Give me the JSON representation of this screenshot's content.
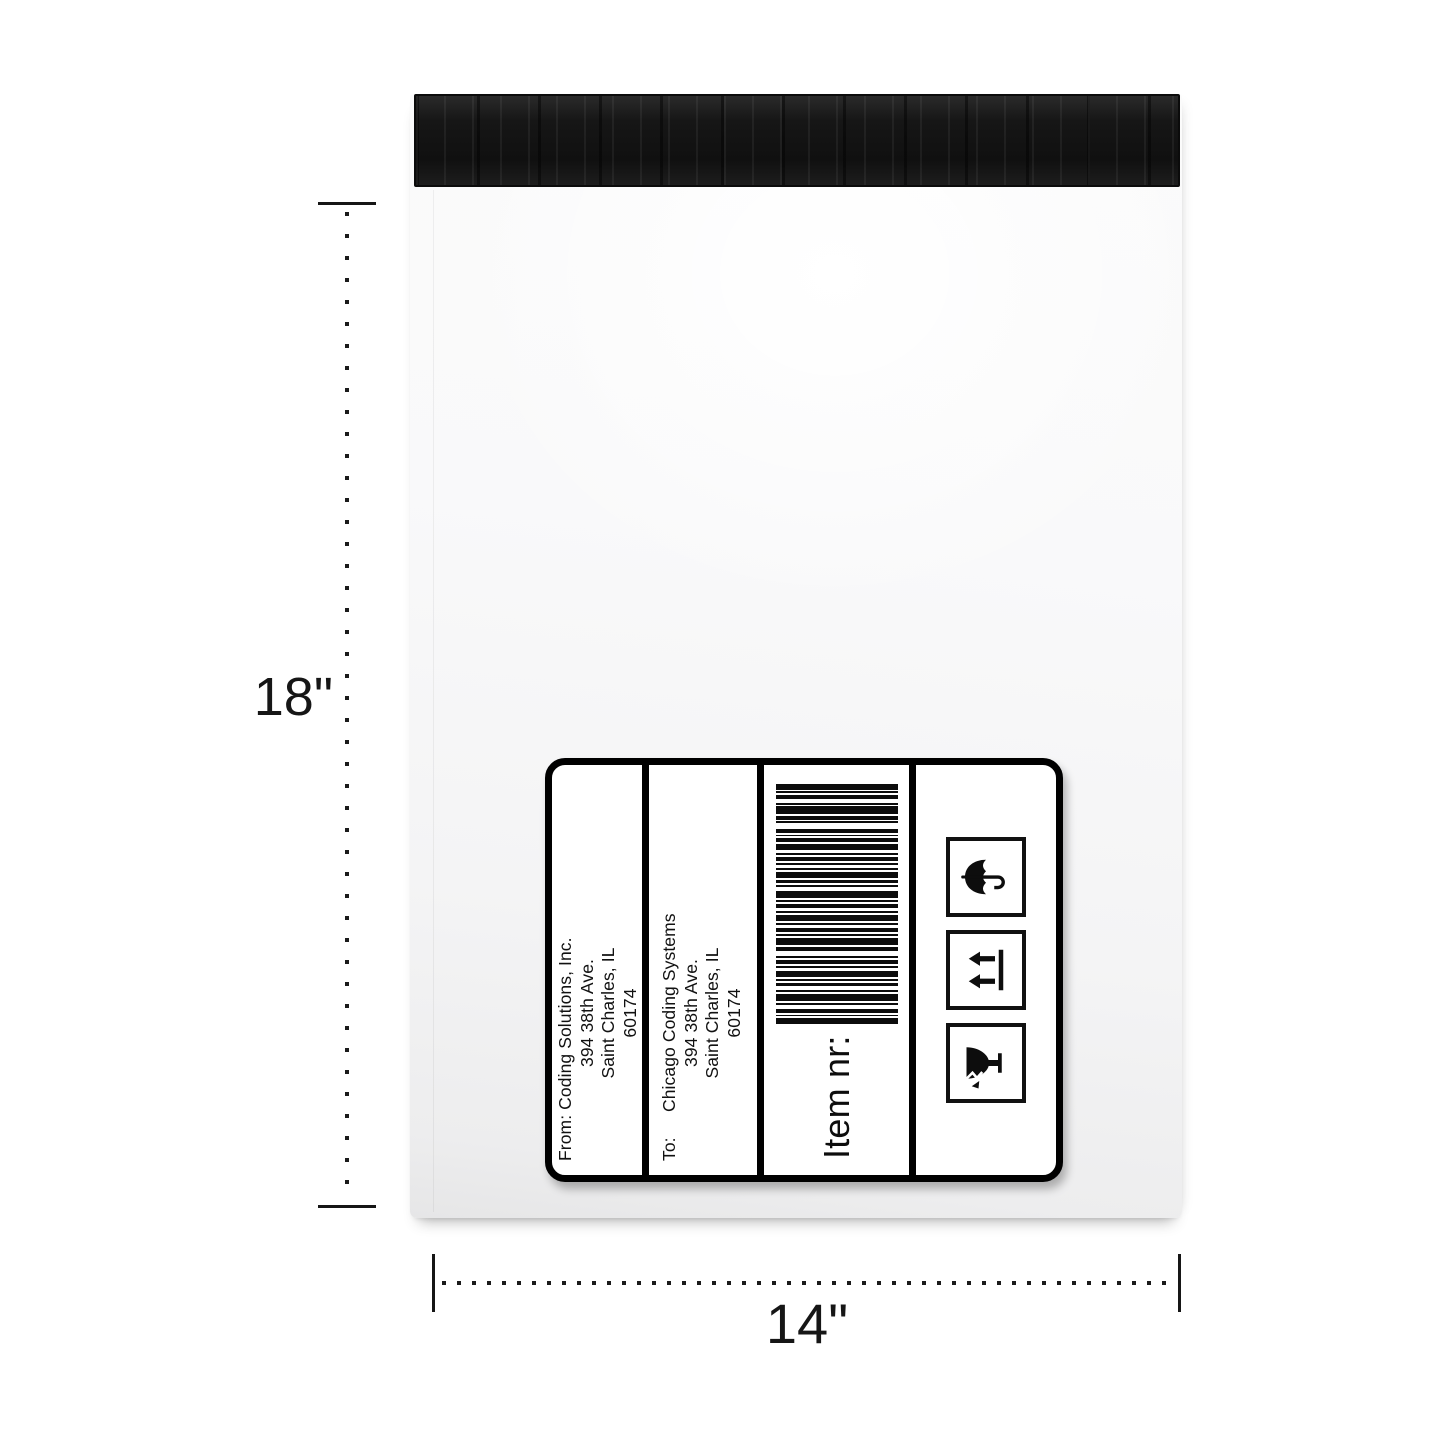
{
  "scene": {
    "background": "#ffffff",
    "envelope_body_color": "#f7f7f8",
    "flap_color": "#161616",
    "accent_black": "#111111"
  },
  "dimensions": {
    "height_label": "18\"",
    "width_label": "14\""
  },
  "shipping_label": {
    "from": {
      "prefix": "From:",
      "name": "Coding Solutions, Inc.",
      "street": "394 38th Ave.",
      "city": "Saint Charles, IL",
      "zip": "60174"
    },
    "to": {
      "prefix": "To:",
      "name": "Chicago Coding Systems",
      "street": "394 38th Ave.",
      "city": "Saint Charles, IL",
      "zip": "60174"
    },
    "item_label": "Item nr:",
    "barcode": {
      "bars": [
        3,
        1,
        1,
        1,
        2,
        2,
        1,
        1,
        4,
        1,
        1,
        2,
        2,
        1,
        1,
        1,
        3,
        2,
        1,
        1,
        2,
        1,
        1,
        3,
        2,
        1,
        4,
        1,
        1,
        1,
        2,
        2,
        1,
        1,
        3,
        1,
        1,
        2,
        2,
        1,
        1,
        1,
        4,
        2,
        1,
        1,
        2,
        1,
        3,
        1,
        1,
        2,
        1,
        1,
        2,
        1,
        1,
        2,
        3,
        1,
        2,
        1,
        1,
        1,
        2,
        3,
        1,
        1,
        2,
        1,
        4,
        1,
        1,
        2,
        2,
        1,
        1,
        1,
        3,
        0
      ]
    },
    "icons": [
      {
        "name": "fragile-icon",
        "meaning": "Fragile — broken glass"
      },
      {
        "name": "this-way-up-icon",
        "meaning": "This way up"
      },
      {
        "name": "keep-dry-icon",
        "meaning": "Keep dry — umbrella"
      }
    ]
  }
}
